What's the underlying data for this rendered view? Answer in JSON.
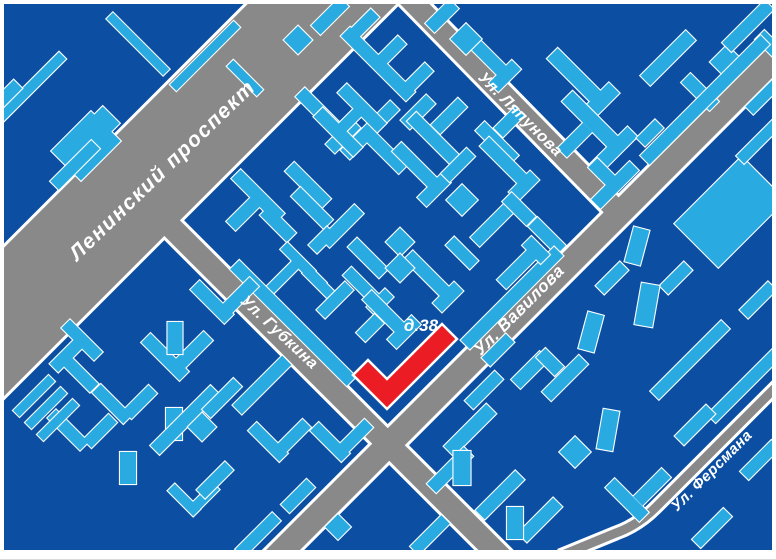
{
  "map": {
    "colors": {
      "background": "#0b4ea2",
      "building": "#29abe2",
      "outline": "#ffffff",
      "road": "#898989",
      "road_casing": "#ffffff",
      "highlight": "#ec1c24",
      "label_text": "#ffffff",
      "frame": "#ffffff"
    },
    "labels": {
      "leninsky_prospekt": "Ленинский проспект",
      "lyapunova": "Ул. Ляпунова",
      "gubkina": "Ул. Губкина",
      "vavilova": "Ул. Вавилова",
      "fersmana": "Ул. Ферсмана",
      "house_38": "д.38"
    },
    "roads": [
      {
        "id": "leninsky-prospekt",
        "path": "M 426,-100 L -100,426",
        "width": 105
      },
      {
        "id": "lyapunova",
        "path": "M 403,-8 L 621,215",
        "width": 21
      },
      {
        "id": "vavilova",
        "path": "M 268,565 L 783,50",
        "width": 24
      },
      {
        "id": "gubkina",
        "path": "M 168,224 L 510,566",
        "width": 22
      },
      {
        "id": "fersmana",
        "path": "M 783,380 L 655,508 Q 638,525 616,533 L 560,556",
        "width": 9
      }
    ],
    "highlight": {
      "label": "д.38",
      "points": "387,409 353,375 368,360 387,379 442,324 457,339"
    },
    "buildings": [
      [
        [
          30,
          88,
          92,
          10,
          -45
        ]
      ],
      [
        [
          8,
          94,
          28,
          12,
          -45
        ]
      ],
      [
        [
          86,
          146,
          56,
          42,
          -45
        ],
        [
          102,
          124,
          26,
          24,
          -45
        ]
      ],
      [
        [
          138,
          44,
          80,
          9,
          45
        ],
        [
          205,
          56,
          90,
          9,
          -45
        ],
        [
          245,
          78,
          9,
          42,
          -45
        ]
      ],
      [
        [
          75,
          165,
          58,
          12,
          -45
        ]
      ],
      [
        [
          378,
          64,
          92,
          13,
          45
        ],
        [
          363,
          25,
          34,
          12,
          -45
        ],
        [
          390,
          52,
          34,
          12,
          -45
        ],
        [
          417,
          79,
          34,
          12,
          -45
        ]
      ],
      [
        [
          320,
          112,
          56,
          13,
          45
        ],
        [
          343,
          136,
          36,
          13,
          -45
        ]
      ],
      [
        [
          370,
          130,
          70,
          13,
          -45
        ],
        [
          387,
          153,
          46,
          13,
          45
        ]
      ],
      [
        [
          418,
          112,
          36,
          13,
          -45
        ]
      ],
      [
        [
          486,
          55,
          54,
          13,
          45
        ],
        [
          505,
          76,
          32,
          13,
          -45
        ]
      ],
      [
        [
          338,
          132,
          56,
          13,
          45
        ],
        [
          362,
          108,
          56,
          13,
          45
        ],
        [
          350,
          120,
          34,
          11,
          -45
        ]
      ],
      [
        [
          308,
          185,
          52,
          13,
          45
        ]
      ],
      [
        [
          435,
          140,
          66,
          13,
          45
        ],
        [
          449,
          116,
          38,
          13,
          -45
        ]
      ],
      [
        [
          497,
          143,
          48,
          13,
          45
        ],
        [
          509,
          122,
          30,
          13,
          -45
        ]
      ],
      [
        [
          505,
          162,
          58,
          13,
          45
        ],
        [
          524,
          186,
          30,
          13,
          -45
        ]
      ],
      [
        [
          258,
          196,
          62,
          13,
          45
        ],
        [
          243,
          214,
          34,
          13,
          -45
        ],
        [
          278,
          224,
          38,
          13,
          45
        ]
      ],
      [
        [
          312,
          208,
          46,
          13,
          45
        ]
      ],
      [
        [
          342,
          226,
          48,
          13,
          -45
        ],
        [
          322,
          240,
          26,
          12,
          -45
        ]
      ],
      [
        [
          298,
          260,
          40,
          10,
          45
        ],
        [
          309,
          272,
          40,
          10,
          45
        ],
        [
          320,
          284,
          40,
          10,
          45
        ],
        [
          283,
          277,
          46,
          10,
          -45
        ]
      ],
      [
        [
          368,
          258,
          44,
          13,
          45
        ]
      ],
      [
        [
          400,
          242,
          20,
          20,
          45
        ]
      ],
      [
        [
          428,
          275,
          56,
          13,
          45
        ],
        [
          448,
          297,
          30,
          13,
          -45
        ]
      ],
      [
        [
          418,
          168,
          60,
          13,
          45
        ],
        [
          434,
          190,
          34,
          13,
          -45
        ]
      ],
      [
        [
          458,
          165,
          36,
          12,
          -45
        ]
      ],
      [
        [
          462,
          200,
          22,
          22,
          45
        ]
      ],
      [
        [
          492,
          225,
          48,
          13,
          -45
        ]
      ],
      [
        [
          519,
          209,
          34,
          13,
          45
        ]
      ],
      [
        [
          547,
          236,
          40,
          13,
          45
        ]
      ],
      [
        [
          512,
          298,
          132,
          13,
          -45
        ]
      ],
      [
        [
          462,
          253,
          34,
          12,
          45
        ]
      ],
      [
        [
          520,
          266,
          52,
          13,
          -45
        ],
        [
          536,
          250,
          26,
          13,
          45
        ]
      ],
      [
        [
          362,
          286,
          42,
          12,
          45
        ],
        [
          380,
          302,
          26,
          12,
          -45
        ],
        [
          400,
          268,
          20,
          20,
          45
        ]
      ],
      [
        [
          335,
          300,
          40,
          12,
          -45
        ]
      ],
      [
        [
          384,
          312,
          48,
          13,
          45
        ],
        [
          404,
          332,
          34,
          13,
          -45
        ],
        [
          370,
          328,
          26,
          13,
          -45
        ]
      ],
      [
        [
          293,
          323,
          165,
          13,
          45
        ]
      ],
      [
        [
          330,
          16,
          40,
          13,
          -45
        ]
      ],
      [
        [
          298,
          40,
          20,
          20,
          45
        ]
      ],
      [
        [
          442,
          16,
          34,
          13,
          -45
        ]
      ],
      [
        [
          466,
          39,
          22,
          22,
          45
        ]
      ],
      [
        [
          575,
          76,
          64,
          15,
          45
        ],
        [
          600,
          102,
          40,
          15,
          -45
        ]
      ],
      [
        [
          592,
          121,
          70,
          15,
          45
        ],
        [
          614,
          150,
          52,
          14,
          -45
        ],
        [
          575,
          140,
          36,
          13,
          -45
        ]
      ],
      [
        [
          668,
          58,
          64,
          14,
          -45
        ]
      ],
      [
        [
          700,
          92,
          40,
          13,
          45
        ]
      ],
      [
        [
          727,
          62,
          24,
          24,
          45
        ]
      ],
      [
        [
          748,
          26,
          60,
          13,
          -45
        ],
        [
          769,
          44,
          26,
          13,
          45
        ]
      ],
      [
        [
          705,
          100,
          170,
          13,
          -45
        ]
      ],
      [
        [
          650,
          133,
          26,
          12,
          -45
        ]
      ],
      [
        [
          615,
          185,
          54,
          13,
          -45
        ],
        [
          602,
          172,
          26,
          13,
          45
        ]
      ],
      [
        [
          730,
          212,
          95,
          62,
          -45
        ]
      ],
      [
        [
          760,
          140,
          56,
          11,
          -45
        ]
      ],
      [
        [
          765,
          95,
          44,
          11,
          -45
        ]
      ],
      [
        [
          612,
          278,
          34,
          12,
          -45
        ]
      ],
      [
        [
          637,
          246,
          16,
          36,
          15
        ]
      ],
      [
        [
          676,
          278,
          34,
          12,
          -45
        ]
      ],
      [
        [
          647,
          305,
          18,
          42,
          10
        ]
      ],
      [
        [
          591,
          332,
          16,
          38,
          15
        ]
      ],
      [
        [
          530,
          370,
          40,
          13,
          -45
        ]
      ],
      [
        [
          565,
          378,
          52,
          13,
          -45
        ],
        [
          550,
          362,
          26,
          13,
          45
        ]
      ],
      [
        [
          690,
          360,
          100,
          12,
          -45
        ]
      ],
      [
        [
          745,
          385,
          95,
          12,
          -45
        ]
      ],
      [
        [
          695,
          425,
          44,
          13,
          -45
        ]
      ],
      [
        [
          758,
          300,
          40,
          12,
          -45
        ]
      ],
      [
        [
          760,
          460,
          44,
          12,
          -45
        ]
      ],
      [
        [
          712,
          528,
          44,
          12,
          -45
        ]
      ],
      [
        [
          627,
          500,
          48,
          13,
          45
        ],
        [
          652,
          487,
          40,
          13,
          -45
        ]
      ],
      [
        [
          608,
          430,
          16,
          40,
          10
        ]
      ],
      [
        [
          498,
          350,
          34,
          12,
          -45
        ]
      ],
      [
        [
          484,
          390,
          42,
          12,
          -45
        ]
      ],
      [
        [
          470,
          430,
          60,
          14,
          -45
        ]
      ],
      [
        [
          450,
          470,
          52,
          13,
          -45
        ]
      ],
      [
        [
          500,
          495,
          56,
          13,
          -45
        ]
      ],
      [
        [
          540,
          520,
          50,
          13,
          -45
        ]
      ],
      [
        [
          462,
          468,
          17,
          34,
          0
        ]
      ],
      [
        [
          515,
          523,
          16,
          32,
          0
        ]
      ],
      [
        [
          430,
          535,
          44,
          12,
          -45
        ]
      ],
      [
        [
          338,
          527,
          18,
          18,
          45
        ]
      ],
      [
        [
          575,
          452,
          22,
          22,
          45
        ]
      ],
      [
        [
          68,
          430,
          46,
          12,
          45
        ],
        [
          100,
          431,
          36,
          12,
          -45
        ]
      ],
      [
        [
          112,
          404,
          44,
          12,
          45
        ],
        [
          140,
          402,
          36,
          12,
          -45
        ]
      ],
      [
        [
          128,
          468,
          16,
          32,
          0
        ]
      ],
      [
        [
          174,
          424,
          16,
          32,
          0
        ]
      ],
      [
        [
          184,
          500,
          36,
          10,
          45
        ],
        [
          206,
          496,
          28,
          10,
          -45
        ]
      ],
      [
        [
          268,
          442,
          44,
          12,
          45
        ],
        [
          294,
          436,
          36,
          12,
          -45
        ]
      ],
      [
        [
          330,
          442,
          44,
          12,
          45
        ],
        [
          356,
          436,
          36,
          12,
          -45
        ]
      ],
      [
        [
          258,
          535,
          52,
          12,
          -45
        ]
      ],
      [
        [
          215,
          480,
          40,
          12,
          -45
        ]
      ],
      [
        [
          298,
          496,
          36,
          12,
          -45
        ]
      ],
      [
        [
          82,
          340,
          46,
          12,
          45
        ],
        [
          66,
          356,
          34,
          12,
          -45
        ],
        [
          80,
          374,
          40,
          12,
          45
        ]
      ],
      [
        [
          34,
          396,
          50,
          9,
          -45
        ],
        [
          46,
          408,
          50,
          9,
          -45
        ],
        [
          58,
          420,
          50,
          9,
          -45
        ]
      ],
      [
        [
          165,
          357,
          54,
          13,
          45
        ],
        [
          194,
          350,
          40,
          13,
          -45
        ]
      ],
      [
        [
          185,
          420,
          85,
          13,
          -45
        ]
      ],
      [
        [
          212,
          302,
          48,
          13,
          45
        ],
        [
          240,
          296,
          40,
          13,
          -45
        ]
      ],
      [
        [
          175,
          338,
          15,
          32,
          0
        ]
      ],
      [
        [
          262,
          385,
          70,
          13,
          -45
        ]
      ],
      [
        [
          222,
          398,
          44,
          12,
          -45
        ]
      ],
      [
        [
          202,
          427,
          20,
          20,
          45
        ]
      ]
    ]
  }
}
